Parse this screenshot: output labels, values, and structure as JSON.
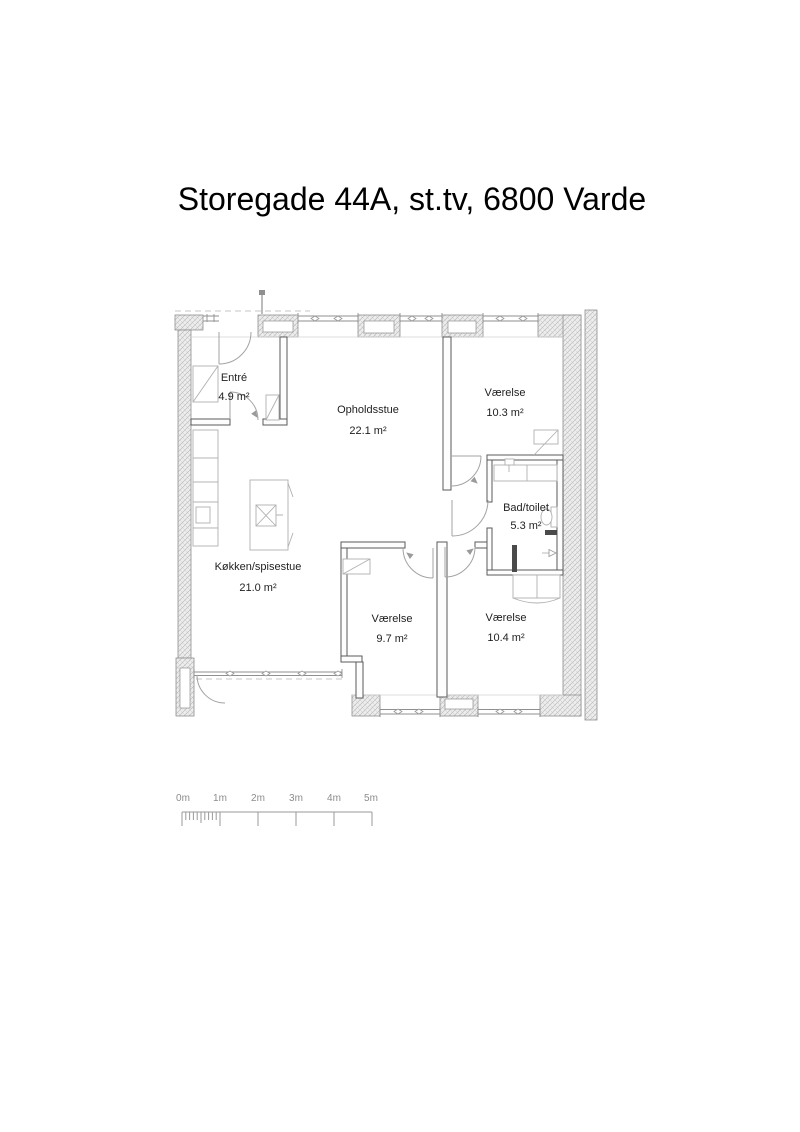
{
  "title": "Storegade 44A, st.tv, 6800 Varde",
  "floor_plan": {
    "rooms": [
      {
        "id": "entre",
        "name": "Entré",
        "area": "4.9 m²"
      },
      {
        "id": "opholdsstue",
        "name": "Opholdsstue",
        "area": "22.1 m²"
      },
      {
        "id": "vaerelse-ne",
        "name": "Værelse",
        "area": "10.3 m²"
      },
      {
        "id": "bad-toilet",
        "name": "Bad/toilet",
        "area": "5.3 m²"
      },
      {
        "id": "koekken",
        "name": "Køkken/spisestue",
        "area": "21.0 m²"
      },
      {
        "id": "vaerelse-sw",
        "name": "Værelse",
        "area": "9.7 m²"
      },
      {
        "id": "vaerelse-se",
        "name": "Værelse",
        "area": "10.4 m²"
      }
    ]
  },
  "scale_bar": {
    "labels": [
      "0m",
      "1m",
      "2m",
      "3m",
      "4m",
      "5m"
    ]
  },
  "colors": {
    "background": "#ffffff",
    "title_text": "#000000",
    "room_text": "#1f1f1f",
    "wall_line": "#5a5a5a",
    "exterior_wall_hatch": "#bdbdbd",
    "scale_text": "#8c8c8c"
  }
}
